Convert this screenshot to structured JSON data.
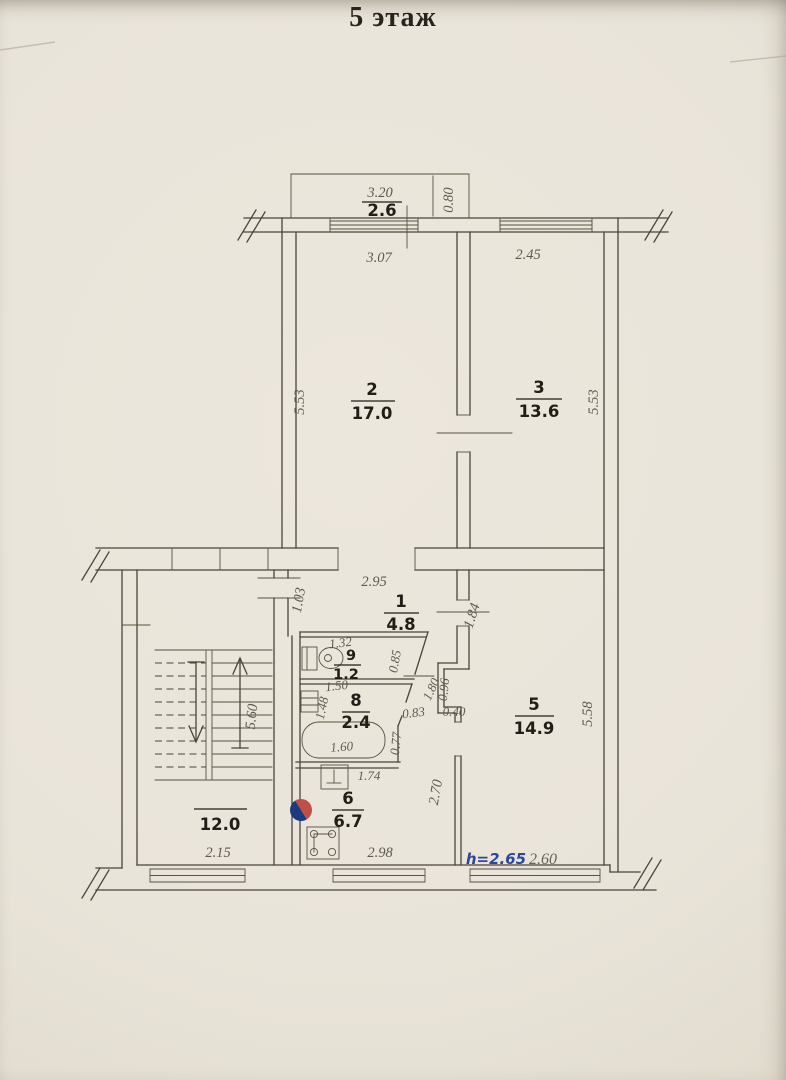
{
  "title": "5 этаж",
  "colors": {
    "paper": "#e9e4d9",
    "ink": "#4a453c",
    "dim": "#5f5a4e",
    "bold": "#211d17",
    "blue": "#2b479e",
    "red": "#c14f44",
    "navy": "#1e3a7e"
  },
  "balcony": {
    "area": "2.6",
    "width": "3.20",
    "depth": "0.80"
  },
  "rooms": {
    "r1": {
      "num": "1",
      "area": "4.8",
      "width": "2.95",
      "left": "1.03",
      "right": "1.84"
    },
    "r2": {
      "num": "2",
      "area": "17.0",
      "width": "3.07",
      "height": "5.53"
    },
    "r3": {
      "num": "3",
      "area": "13.6",
      "width": "2.45",
      "height": "5.53"
    },
    "r5": {
      "num": "5",
      "area": "14.9",
      "height": "5.58",
      "ceiling_note": "h=2.65",
      "window_note": "2.60"
    },
    "r6": {
      "num": "6",
      "area": "6.7",
      "width": "2.98",
      "depth": "2.70"
    },
    "r8": {
      "num": "8",
      "area": "2.4",
      "height": "1.48",
      "tub": "1.60",
      "front": "1.74"
    },
    "r9": {
      "num": "9",
      "area": "1.2",
      "top": "1.32",
      "bottom": "1.50",
      "height": "0.85",
      "diag": "1.80"
    }
  },
  "stairwell": {
    "area": "12.0",
    "width": "2.15",
    "depth": "5.60"
  },
  "corridor": {
    "w1": "0.83",
    "w2": "0.40",
    "w3": "0.77",
    "w4": "0.96"
  }
}
